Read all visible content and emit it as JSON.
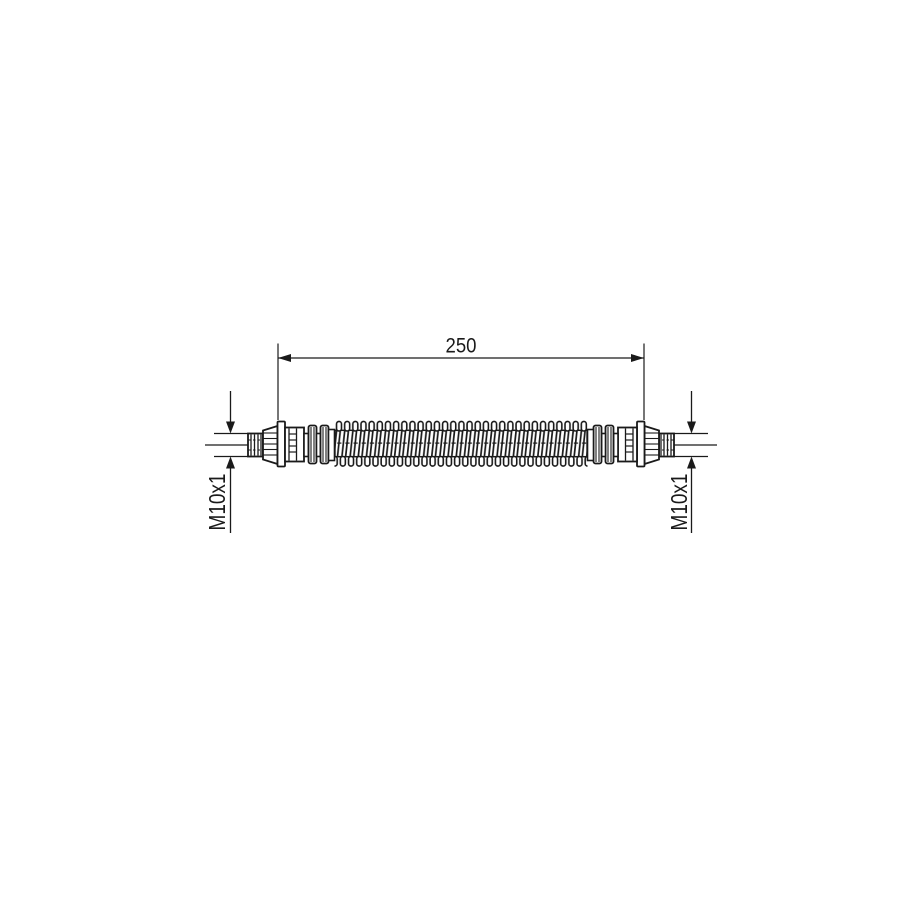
{
  "page": {
    "background": "#ffffff"
  },
  "drawing": {
    "type": "technical-part-drawing",
    "subject": "flexible hose with threaded end fittings",
    "line_color": "#1a1a1a",
    "labels": {
      "length_dimension": "250",
      "left_thread": "M10x1",
      "right_thread": "M10x1"
    }
  }
}
